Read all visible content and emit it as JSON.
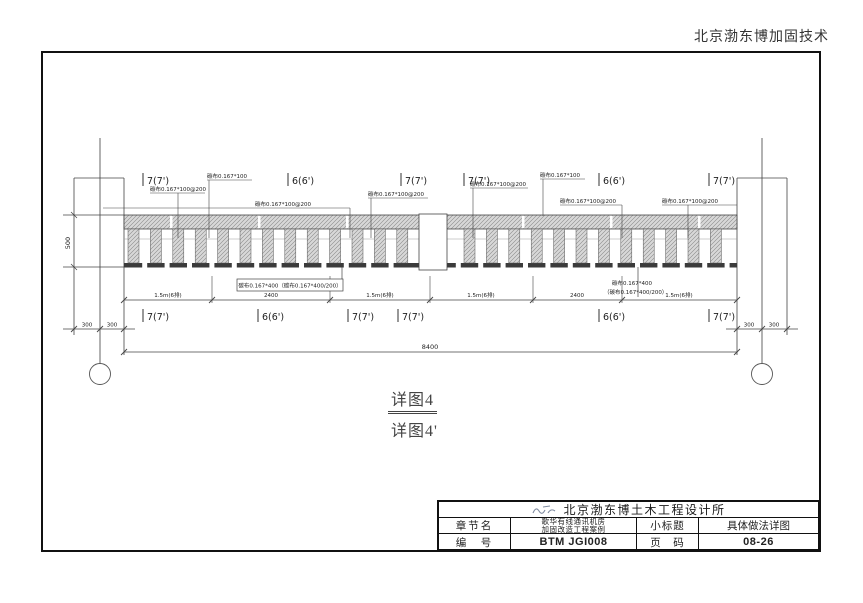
{
  "page_header": {
    "text": "北京渤东博加固技术"
  },
  "drawing": {
    "top_labels": [
      "7(7')",
      "6(6')",
      "7(7')",
      "7(7')",
      "6(6')",
      "7(7')"
    ],
    "bottom_labels": [
      "7(7')",
      "6(6')",
      "7(7')",
      "7(7')",
      "6(6')",
      "7(7')"
    ],
    "cfrp_note_200": "碳布0.167*100@200",
    "cfrp_note_100": "碳布0.167*100",
    "cfrp_note_400_boxed": "碳布0.167*400（碳布0.167*400/200）",
    "cfrp_note_400_line1": "碳布0.167*400",
    "cfrp_note_400_line2": "（碳布0.167*400/200）",
    "dim_texts": [
      "1.5m(6排)",
      "2400",
      "1.5m(6排)",
      "1.5m(6排)",
      "2400",
      "1.5m(6排)"
    ],
    "dim_300": "300",
    "dim_depth": "500",
    "dim_total": "8400",
    "caption_main": "详图4",
    "caption_sub": "详图4'"
  },
  "title_block": {
    "institute": "北京渤东博土木工程设计所",
    "section_label": "章节名",
    "section_value_line1": "歌华有线通讯机房",
    "section_value_line2": "加固改造工程案例",
    "subtitle_label": "小标题",
    "subtitle_value": "具体做法详图",
    "number_label": "编　号",
    "number_value": "BTM JGI008",
    "page_label": "页　码",
    "page_value": "08-26"
  }
}
